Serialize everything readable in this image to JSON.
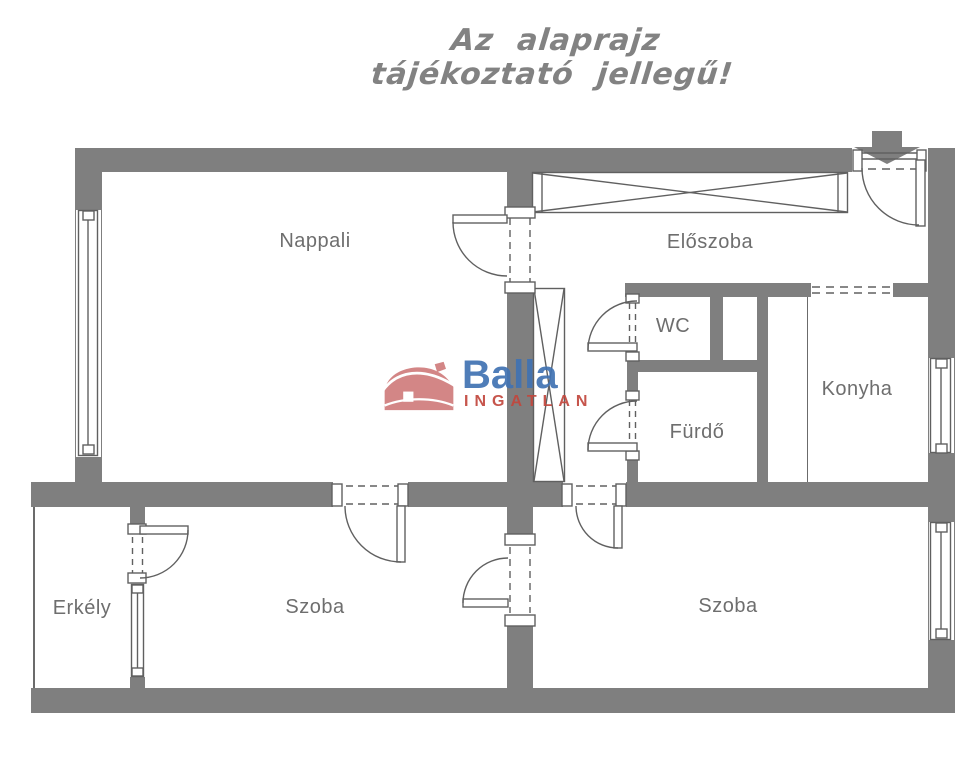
{
  "disclaimer": {
    "line1": "Az alaprajz",
    "line2": "tájékoztató jellegű!"
  },
  "watermark": {
    "brand": "Balla",
    "subtitle": "INGATLAN"
  },
  "rooms": [
    {
      "id": "nappali",
      "label": "Nappali"
    },
    {
      "id": "eloszoba",
      "label": "Előszoba"
    },
    {
      "id": "wc",
      "label": "WC"
    },
    {
      "id": "furdo",
      "label": "Fürdő"
    },
    {
      "id": "konyha",
      "label": "Konyha"
    },
    {
      "id": "szoba-bal",
      "label": "Szoba"
    },
    {
      "id": "szoba-jobb",
      "label": "Szoba"
    },
    {
      "id": "erkely",
      "label": "Erkély"
    }
  ],
  "colors": {
    "wall": "#7f7f7f",
    "symbol_line": "#606060",
    "room_label": "#6e6e6e",
    "disclaimer_text": "#828282",
    "brand_blue": "#4173b3",
    "brand_red": "#c2473d",
    "house_pink": "#d07c7c",
    "background": "#ffffff"
  }
}
